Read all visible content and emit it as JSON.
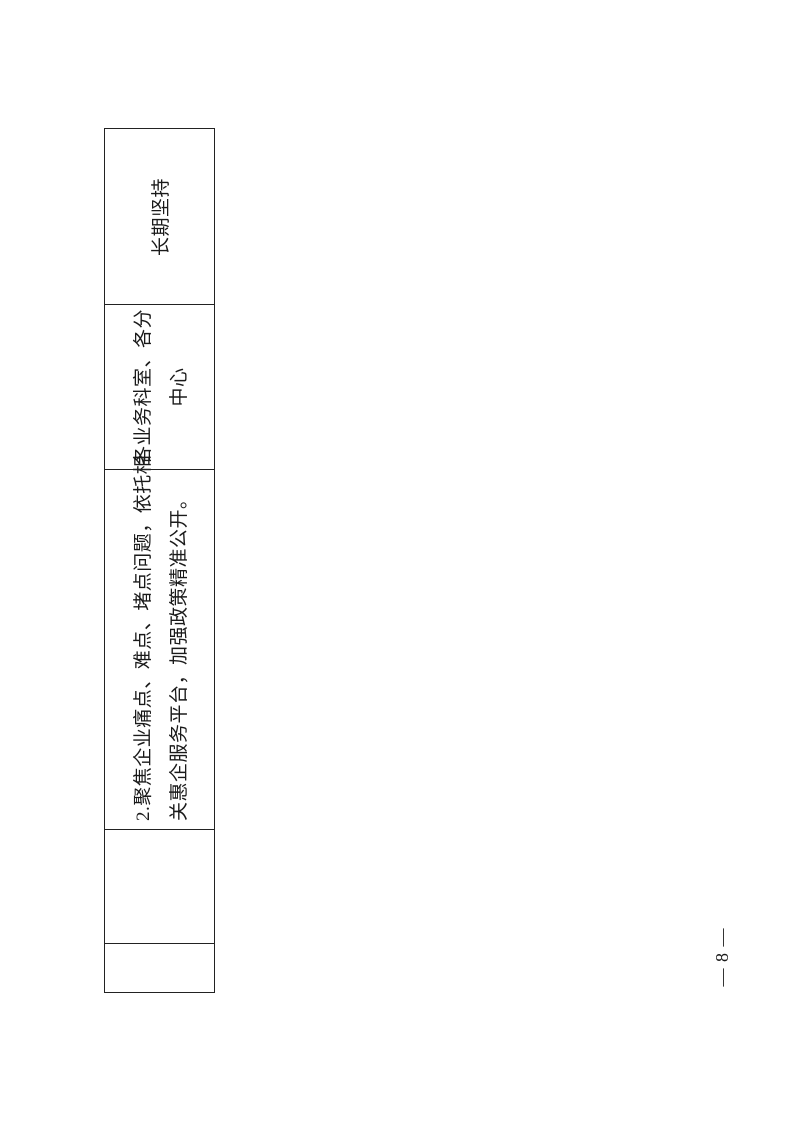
{
  "page": {
    "number_label": "— 8 —"
  },
  "table": {
    "cells": [
      {
        "id": "empty-1",
        "lines": []
      },
      {
        "id": "empty-2",
        "lines": []
      },
      {
        "id": "task",
        "lines": [
          "2.聚焦企业痛点、难点、堵点问题，依托相",
          "关惠企服务平台，加强政策精准公开。"
        ],
        "full_text": "2.聚焦企业痛点、难点、堵点问题，依托相关惠企服务平台，加强政策精准公开。"
      },
      {
        "id": "department",
        "lines": [
          "各业务科室、各分",
          "中心"
        ],
        "full_text": "各业务科室、各分中心"
      },
      {
        "id": "deadline",
        "lines": [
          "长期坚持"
        ],
        "full_text": "长期坚持"
      }
    ]
  },
  "colors": {
    "border": "#222222",
    "text": "#1a1a1a",
    "background": "#ffffff"
  }
}
